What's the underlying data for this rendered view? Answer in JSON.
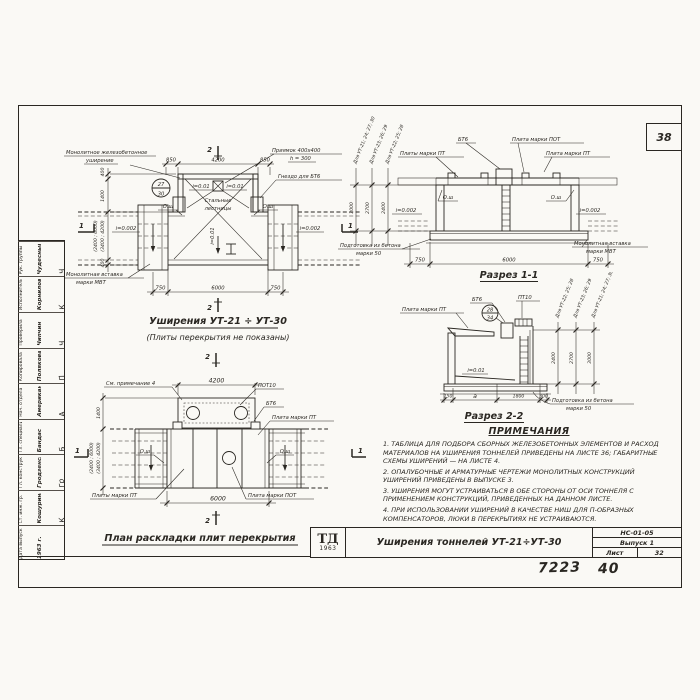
{
  "sheet": {
    "corner_number": "38",
    "stamp_number_left": "7223",
    "stamp_number_right": "40",
    "colors": {
      "ink": "#2a2722",
      "paper": "#faf9f5"
    }
  },
  "plan_top": {
    "title": "Уширения УТ-21 ÷ УТ-30",
    "subtitle": "(Плиты перекрытия не показаны)",
    "label_widening": [
      "Монолитное железобетонное",
      "уширение"
    ],
    "label_pit": [
      "Приямок 400х400",
      "h = 300"
    ],
    "label_socket": "Гнездо для БТ6",
    "label_ladders": [
      "Стальные",
      "лестницы"
    ],
    "label_insert": [
      "Монолитная вставка",
      "марки МВТ"
    ],
    "detail_bubble": {
      "top": "27",
      "bottom": "30"
    },
    "slopes": {
      "left": "i=0.01",
      "right": "i=0.01",
      "mid": "i=0.01",
      "edge_left": "i=0.002",
      "edge_right": "i=0.002"
    },
    "axis": {
      "left": "О.ш",
      "right": "О.ш"
    },
    "dims": {
      "top": [
        "850",
        "4200",
        "850"
      ],
      "bottom": [
        "750",
        "6000",
        "750"
      ],
      "left": [
        "400",
        "1400",
        "(2400 ; 6000)",
        "(3400 ; 4200)",
        "400"
      ]
    },
    "marks": {
      "s2": "2",
      "s1": "1"
    }
  },
  "section1": {
    "title": "Разрез 1-1",
    "label_bt6": "БТ6",
    "label_pot": "Плита марки ПОТ",
    "label_pt_left": "Плиты марки ПТ",
    "label_pt_right": "Плита марки ПТ",
    "label_insert": [
      "Монолитная вставка",
      "марки МВТ"
    ],
    "label_prep": [
      "Подготовка из бетона",
      "марки 50"
    ],
    "axis": {
      "left": "О.ш",
      "right": "О.ш"
    },
    "slopes": {
      "left": "i=0.002",
      "right": "i=0.002"
    },
    "dims_bottom": [
      "750",
      "6000",
      "750"
    ],
    "height_dims": [
      {
        "label": "Для УТ-21; 24; 27; 30",
        "value": "3000"
      },
      {
        "label": "Для УТ-23; 26; 29",
        "value": "2700"
      },
      {
        "label": "Для УТ-22; 25; 28",
        "value": "2400"
      }
    ]
  },
  "section2": {
    "title": "Разрез 2-2",
    "label_pt": "Плита марки ПТ",
    "label_bt6": "БТ6",
    "label_pt10": "ПТ10",
    "detail_bubble": {
      "top": "28",
      "bottom": "34"
    },
    "slope": "i=0.01",
    "label_prep": [
      "Подготовка из бетона",
      "марки 50"
    ],
    "dims_bottom": [
      "150",
      "а",
      "1800",
      "300"
    ],
    "height_dims": [
      {
        "label": "Для УТ-22; 25; 28",
        "value": "2400"
      },
      {
        "label": "Для УТ-23; 26; 29",
        "value": "2700"
      },
      {
        "label": "Для УТ-21; 24; 27; 30",
        "value": "3000"
      }
    ]
  },
  "plan_bottom": {
    "title": "План раскладки плит перекрытия",
    "label_note": "См. примечание 4",
    "label_pot10": "ПОТ10",
    "label_bt6": "БТ6",
    "label_pt": "Плита марки ПТ",
    "label_pt_plural": "Плиты марки ПТ",
    "label_pot": "Плита марки ПОТ",
    "axis": {
      "left": "О.ш",
      "right": "О.ш"
    },
    "dims": {
      "top": "4200",
      "bottom": "6000",
      "left": [
        "1400",
        "(2400 ; 6000)",
        "(3400 ; 4200)"
      ]
    },
    "marks": {
      "s2": "2",
      "s1": "1"
    }
  },
  "notes": {
    "heading": "Примечания",
    "items": [
      "1. Таблица для подбора сборных железобетонных элементов и расход материалов на уширения тоннелей приведены на листе 36; габаритные схемы уширений — на листе 4.",
      "2. Опалубочные и арматурные чертежи монолитных конструкций уширений приведены в выпуске 3.",
      "3. Уширения могут устраиваться в обе стороны от оси тоннеля с применением конструкций, приведенных на данном листе.",
      "4. При использовании уширений в качестве ниш для П-образных компенсаторов, люки в перекрытиях не устраиваются."
    ]
  },
  "titleblock": {
    "logo": "ТД",
    "logo_year": "1963",
    "title": "Уширения тоннелей УТ-21÷УТ-30",
    "code": "НС-01-05",
    "issue": "Выпуск 1",
    "sheet_label": "Лист",
    "sheet_number": "32"
  },
  "stamp": {
    "rows": [
      {
        "role": "Дата выпуска",
        "name": "1963 г.",
        "sig": ""
      },
      {
        "role": "Ст. инж. гр.",
        "name": "Кошурина",
        "sig": "К"
      },
      {
        "role": "Гл. конструктор",
        "name": "Гродзенский",
        "sig": "Гр"
      },
      {
        "role": "Гл. специалист",
        "name": "Бандас",
        "sig": "Б"
      },
      {
        "role": "Нач. отдела",
        "name": "Американский",
        "sig": "А"
      },
      {
        "role": "Копировала",
        "name": "Полякова",
        "sig": "П"
      },
      {
        "role": "Проверила",
        "name": "Чипчин",
        "sig": "Ч"
      },
      {
        "role": "Исполнитель",
        "name": "Корнилов",
        "sig": "К"
      },
      {
        "role": "Рук. группы",
        "name": "Чудесный",
        "sig": "Ч"
      }
    ]
  }
}
